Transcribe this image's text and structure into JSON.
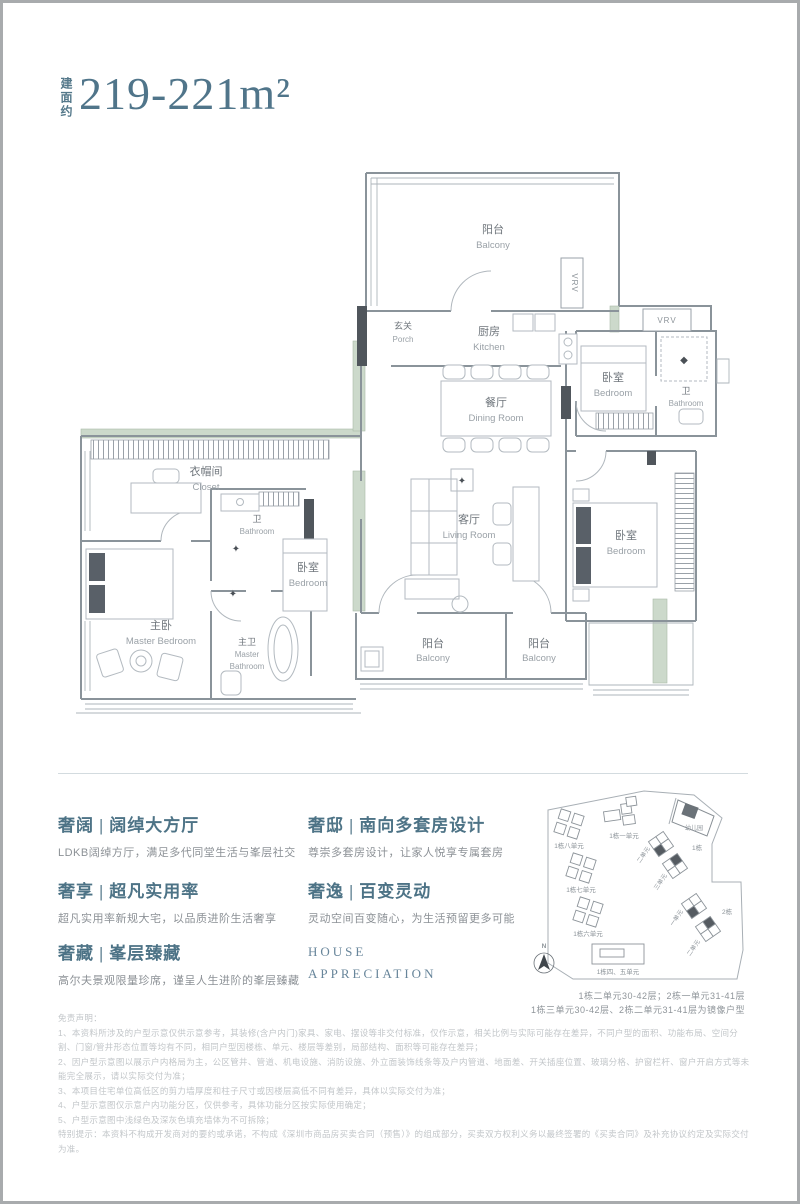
{
  "title": {
    "area_label": "建面约",
    "area_value": "219-221m²"
  },
  "floorplan": {
    "rooms": [
      {
        "zh": "阳台",
        "en": "Balcony"
      },
      {
        "zh": "玄关",
        "en": "Porch"
      },
      {
        "zh": "厨房",
        "en": "Kitchen"
      },
      {
        "zh": "卧室",
        "en": "Bedroom"
      },
      {
        "zh": "卫",
        "en": "Bathroom"
      },
      {
        "zh": "餐厅",
        "en": "Dining Room"
      },
      {
        "zh": "衣帽间",
        "en": "Closet"
      },
      {
        "zh": "卫",
        "en": "Bathroom"
      },
      {
        "zh": "卧室",
        "en": "Bedroom"
      },
      {
        "zh": "主卧",
        "en": "Master Bedroom"
      },
      {
        "zh": "主卫",
        "en": "Master",
        "en2": "Bathroom"
      },
      {
        "zh": "客厅",
        "en": "Living Room"
      },
      {
        "zh": "卧室",
        "en": "Bedroom"
      },
      {
        "zh": "阳台",
        "en": "Balcony"
      },
      {
        "zh": "阳台",
        "en": "Balcony"
      }
    ],
    "equipment": [
      {
        "label": "VRV"
      },
      {
        "label": "VRV"
      }
    ]
  },
  "features": {
    "left": [
      {
        "title": "奢阔 | 阔绰大方厅",
        "desc": "LDKB阔绰方厅，满足多代同堂生活与峯层社交"
      },
      {
        "title": "奢享 | 超凡实用率",
        "desc": "超凡实用率新规大宅，以品质进阶生活奢享"
      },
      {
        "title": "奢藏 | 峯层臻藏",
        "desc": "高尔夫景观限量珍席，谨呈人生进阶的峯层臻藏"
      }
    ],
    "right": [
      {
        "title": "奢邸 | 南向多套房设计",
        "desc": "尊崇多套房设计，让家人悦享专属套房"
      },
      {
        "title": "奢逸 | 百变灵动",
        "desc": "灵动空间百变随心，为生活预留更多可能"
      }
    ],
    "brand_line1": "HOUSE",
    "brand_line2": "APPRECIATION"
  },
  "siteplan": {
    "compass": "N",
    "labels": {
      "b8": "1栋八单元",
      "b1u1": "1栋一单元",
      "kindergarten": "幼儿园",
      "b7": "1栋七单元",
      "b6": "1栋六单元",
      "b45": "1栋四、五单元",
      "t1": "1栋",
      "t1u2": "二单元",
      "t1u3": "三单元",
      "t2": "2栋",
      "t2u1": "一单元",
      "t2u2": "二单元"
    },
    "caption_line1": "1栋二单元30-42层；2栋一单元31-41层",
    "caption_line2": "1栋三单元30-42层、2栋二单元31-41层为镜像户型"
  },
  "disclaimer": {
    "heading": "免责声明：",
    "lines": [
      "1、本资料所涉及的户型示意仅供示意参考，其装修(含户内门)家具、家电、摆设等非交付标准，仅作示意，相关比例与实际可能存在差异，不同户型的面积、功能布局、空间分割、门窗/管井形态位置等均有不同，相同户型因楼栋、单元、楼层等差别，局部结构、面积等可能存在差异；",
      "2、因户型示意图以展示户内格局为主，公区管井、管道、机电设施、消防设施、外立面装饰线条等及户内管道、地面差、开关插座位置、玻璃分格、护窗栏杆、窗户开启方式等未能完全展示，请以实际交付为准；",
      "3、本项目住宅单位高低区的剪力墙厚度和柱子尺寸或因楼层高低不同有差异，具体以实际交付为准；",
      "4、户型示意图仅示意户内功能分区，仅供参考，具体功能分区按实际使用确定；",
      "5、户型示意图中浅绿色及深灰色填充墙体为不可拆除；",
      "特别提示：本资料不构成开发商对的要约或承诺，不构成《深圳市商品房买卖合同（预售）》的组成部分，买卖双方权利义务以最终签署的《买卖合同》及补充协议约定及实际交付为准。"
    ]
  },
  "colors": {
    "accent": "#4d7386",
    "wall": "#8a939a",
    "sage": "#ccd9cb",
    "dark": "#50565c"
  }
}
